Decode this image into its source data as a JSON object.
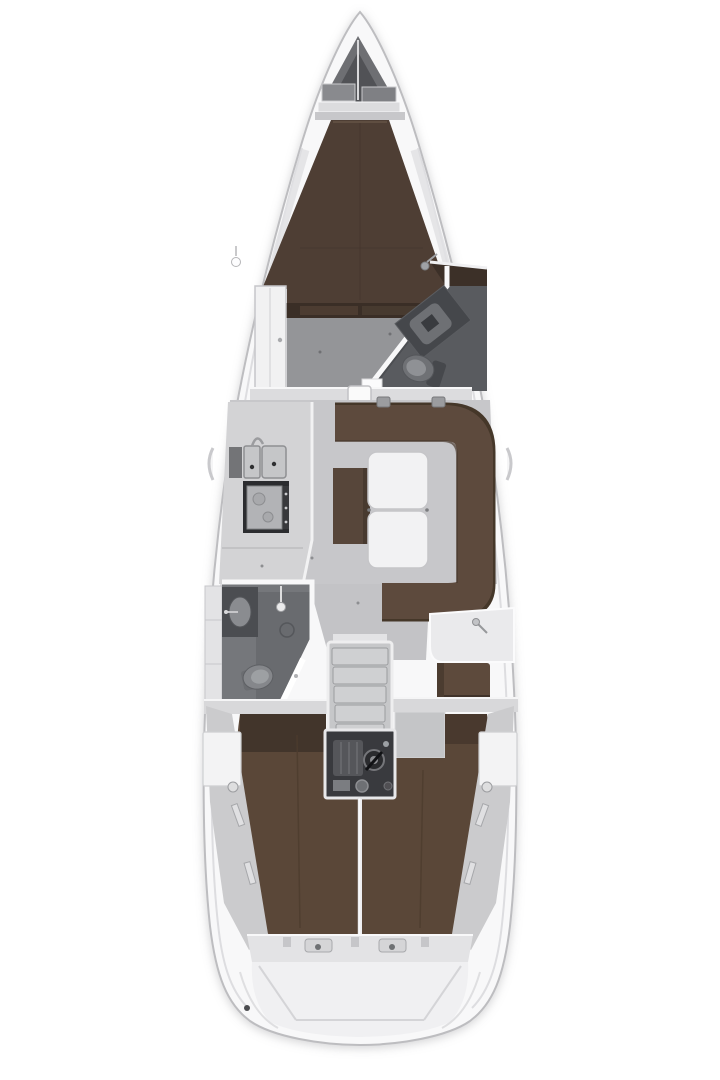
{
  "diagram": {
    "type": "sailboat-interior-floor-plan",
    "orientation": "bow-up",
    "background": "#ffffff"
  },
  "palette": {
    "hull": "#f8f8f9",
    "hullStroke": "#bdbdc0",
    "softLine": "#dddde0",
    "shade": "#e2e2e4",
    "wallWhite": "#f8f8f9",
    "lockerWall": "#6e6f73",
    "lockerInner": "#515256",
    "bulkhead": "#dcdcde",
    "headboard": "#c7c7ca",
    "vberth": "#4e3e34",
    "shelfDark": "#3a2e26",
    "floorFwd": "#949598",
    "floorMain": "#c7c7ca",
    "panel": "#d8d8da",
    "counter": "#d3d3d5",
    "headFloor": "#595b5f",
    "headFloorAft": "#75777b",
    "showerFloor": "#696b6f",
    "fixtureDark": "#4b4d51",
    "fixtureMid": "#8a8c90",
    "stoveFrame": "#2b2c2f",
    "stoveTop": "#b2b3b6",
    "settee": "#5d4a3d",
    "setteeBack": "#453729",
    "bench": "#57463a",
    "tableWhite": "#f2f2f3",
    "berth": "#5a4738",
    "berthShadow": "#2f2620",
    "seam": "#4d3c2e",
    "stairTread": "#cfd0d2",
    "engineBox": "#393a3e",
    "engineBlock": "#55565a",
    "deckWedge": "#cbcbcd",
    "sternStep": "#e3e3e5",
    "transom": "#f0f0f2",
    "panelLine": "#d4d4d7"
  },
  "areas": [
    {
      "id": "anchor-locker"
    },
    {
      "id": "forward-v-berth"
    },
    {
      "id": "forward-cabin-floor"
    },
    {
      "id": "wardrobe"
    },
    {
      "id": "forward-head"
    },
    {
      "id": "salon"
    },
    {
      "id": "galley"
    },
    {
      "id": "settee-u-shaped"
    },
    {
      "id": "salon-table"
    },
    {
      "id": "salon-bench"
    },
    {
      "id": "aft-head-shower"
    },
    {
      "id": "chart-table"
    },
    {
      "id": "nav-seat"
    },
    {
      "id": "companionway-stairs"
    },
    {
      "id": "engine-compartment"
    },
    {
      "id": "aft-berth-port"
    },
    {
      "id": "aft-berth-starboard"
    },
    {
      "id": "stern-transom"
    }
  ]
}
